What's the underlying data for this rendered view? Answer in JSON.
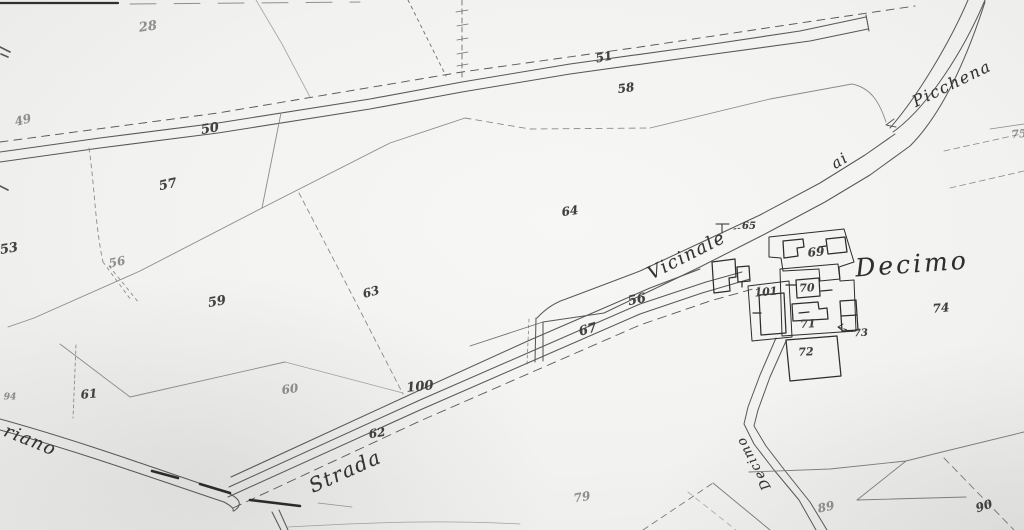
{
  "map": {
    "kind": "historical cadastral map scan",
    "paper_color": "#f2f2f0",
    "ink_color": "#3a3a3a",
    "road_ink_color": "#585858",
    "faint_line_color": "#8b8b8b"
  },
  "map_labels": [
    {
      "name": "parcel-28",
      "text": "28",
      "x": 148,
      "y": 27,
      "rot": -8,
      "size": 13,
      "cls": "num faint"
    },
    {
      "name": "parcel-49",
      "text": "49",
      "x": 23,
      "y": 120,
      "rot": -15,
      "size": 12,
      "cls": "num faint"
    },
    {
      "name": "road-parcel-50",
      "text": "50",
      "x": 210,
      "y": 129,
      "rot": -10,
      "size": 13,
      "cls": "num"
    },
    {
      "name": "road-parcel-51",
      "text": "51",
      "x": 604,
      "y": 57,
      "rot": -12,
      "size": 12,
      "cls": "num"
    },
    {
      "name": "parcel-58",
      "text": "58",
      "x": 626,
      "y": 88,
      "rot": -8,
      "size": 12,
      "cls": "num"
    },
    {
      "name": "parcel-57",
      "text": "57",
      "x": 168,
      "y": 185,
      "rot": -12,
      "size": 13,
      "cls": "num"
    },
    {
      "name": "parcel-53",
      "text": "53",
      "x": 9,
      "y": 249,
      "rot": -10,
      "size": 13,
      "cls": "num"
    },
    {
      "name": "parcel-56-west",
      "text": "56",
      "x": 117,
      "y": 262,
      "rot": -12,
      "size": 12,
      "cls": "num faint"
    },
    {
      "name": "parcel-59",
      "text": "59",
      "x": 217,
      "y": 302,
      "rot": -10,
      "size": 13,
      "cls": "num"
    },
    {
      "name": "parcel-63",
      "text": "63",
      "x": 371,
      "y": 292,
      "rot": -15,
      "size": 12,
      "cls": "num"
    },
    {
      "name": "parcel-64",
      "text": "64",
      "x": 570,
      "y": 211,
      "rot": -8,
      "size": 12,
      "cls": "num"
    },
    {
      "name": "parcel-56-road",
      "text": "56",
      "x": 637,
      "y": 300,
      "rot": -12,
      "size": 13,
      "cls": "num"
    },
    {
      "name": "parcel-67",
      "text": "67",
      "x": 588,
      "y": 330,
      "rot": -15,
      "size": 13,
      "cls": "num"
    },
    {
      "name": "parcel-100",
      "text": "100",
      "x": 420,
      "y": 387,
      "rot": -6,
      "size": 13,
      "cls": "num"
    },
    {
      "name": "parcel-62",
      "text": "62",
      "x": 377,
      "y": 433,
      "rot": -10,
      "size": 12,
      "cls": "num"
    },
    {
      "name": "parcel-60",
      "text": "60",
      "x": 290,
      "y": 389,
      "rot": -8,
      "size": 12,
      "cls": "num faint"
    },
    {
      "name": "parcel-61",
      "text": "61",
      "x": 89,
      "y": 394,
      "rot": -5,
      "size": 12,
      "cls": "num"
    },
    {
      "name": "parcel-94",
      "text": "94",
      "x": 10,
      "y": 398,
      "rot": 0,
      "size": 9,
      "cls": "num faint"
    },
    {
      "name": "parcel-79",
      "text": "79",
      "x": 582,
      "y": 497,
      "rot": -10,
      "size": 12,
      "cls": "num faint"
    },
    {
      "name": "parcel-89",
      "text": "89",
      "x": 826,
      "y": 507,
      "rot": -12,
      "size": 12,
      "cls": "num faint"
    },
    {
      "name": "parcel-90",
      "text": "90",
      "x": 984,
      "y": 506,
      "rot": -18,
      "size": 12,
      "cls": "num"
    },
    {
      "name": "parcel-65",
      "text": "65",
      "x": 749,
      "y": 227,
      "rot": 0,
      "size": 10,
      "cls": "num"
    },
    {
      "name": "parcel-69",
      "text": "69",
      "x": 816,
      "y": 252,
      "rot": -5,
      "size": 12,
      "cls": "num"
    },
    {
      "name": "parcel-70",
      "text": "70",
      "x": 807,
      "y": 288,
      "rot": -3,
      "size": 11,
      "cls": "num"
    },
    {
      "name": "parcel-101",
      "text": "101",
      "x": 766,
      "y": 292,
      "rot": -5,
      "size": 11,
      "cls": "num"
    },
    {
      "name": "parcel-71",
      "text": "71",
      "x": 808,
      "y": 324,
      "rot": -3,
      "size": 11,
      "cls": "num"
    },
    {
      "name": "parcel-73",
      "text": "73",
      "x": 861,
      "y": 334,
      "rot": -3,
      "size": 10,
      "cls": "num"
    },
    {
      "name": "parcel-72",
      "text": "72",
      "x": 806,
      "y": 352,
      "rot": -3,
      "size": 11,
      "cls": "num"
    },
    {
      "name": "parcel-74",
      "text": "74",
      "x": 941,
      "y": 308,
      "rot": -5,
      "size": 12,
      "cls": "num"
    },
    {
      "name": "parcel-75",
      "text": "75",
      "x": 1019,
      "y": 134,
      "rot": -5,
      "size": 11,
      "cls": "num faint"
    },
    {
      "name": "road-name-riano",
      "text": "riano",
      "x": 30,
      "y": 441,
      "rot": 22,
      "size": 18,
      "cls": "place"
    },
    {
      "name": "road-name-strada",
      "text": "Strada",
      "x": 345,
      "y": 471,
      "rot": -24,
      "size": 20,
      "cls": "place"
    },
    {
      "name": "road-name-vicinale",
      "text": "Vicinale",
      "x": 687,
      "y": 256,
      "rot": -27,
      "size": 18,
      "cls": "place"
    },
    {
      "name": "road-name-ai",
      "text": "ai",
      "x": 840,
      "y": 161,
      "rot": -32,
      "size": 15,
      "cls": "place"
    },
    {
      "name": "road-name-picchena",
      "text": "Picchena",
      "x": 952,
      "y": 84,
      "rot": -26,
      "size": 16,
      "cls": "place"
    },
    {
      "name": "settlement-decimo",
      "text": "Decimo",
      "x": 912,
      "y": 264,
      "rot": -4,
      "size": 25,
      "cls": "big-place"
    },
    {
      "name": "road-name-decimo",
      "text": "Decimo",
      "x": 754,
      "y": 463,
      "rot": -118,
      "size": 13,
      "cls": "place"
    }
  ]
}
